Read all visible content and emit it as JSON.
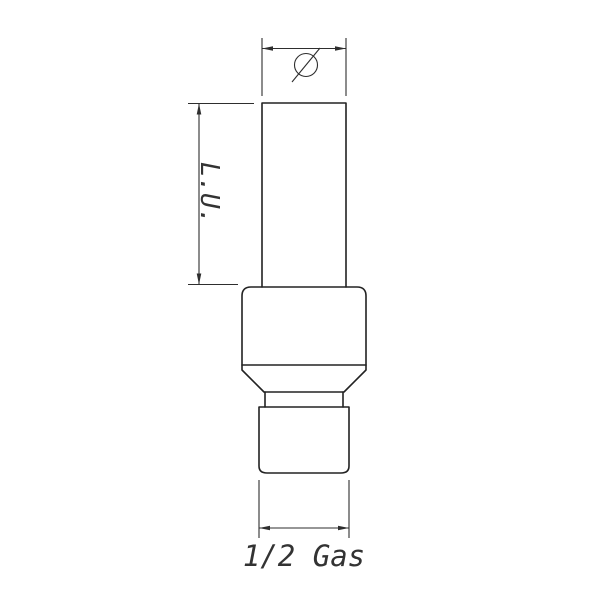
{
  "page": {
    "background": "#ffffff"
  },
  "drawing": {
    "line_color": "#2e2e2e",
    "dimensions": {
      "diameter": {
        "symbol": "Ø"
      },
      "length": {
        "label": "L.U."
      },
      "thread": {
        "label": "1/2 Gas"
      }
    }
  }
}
